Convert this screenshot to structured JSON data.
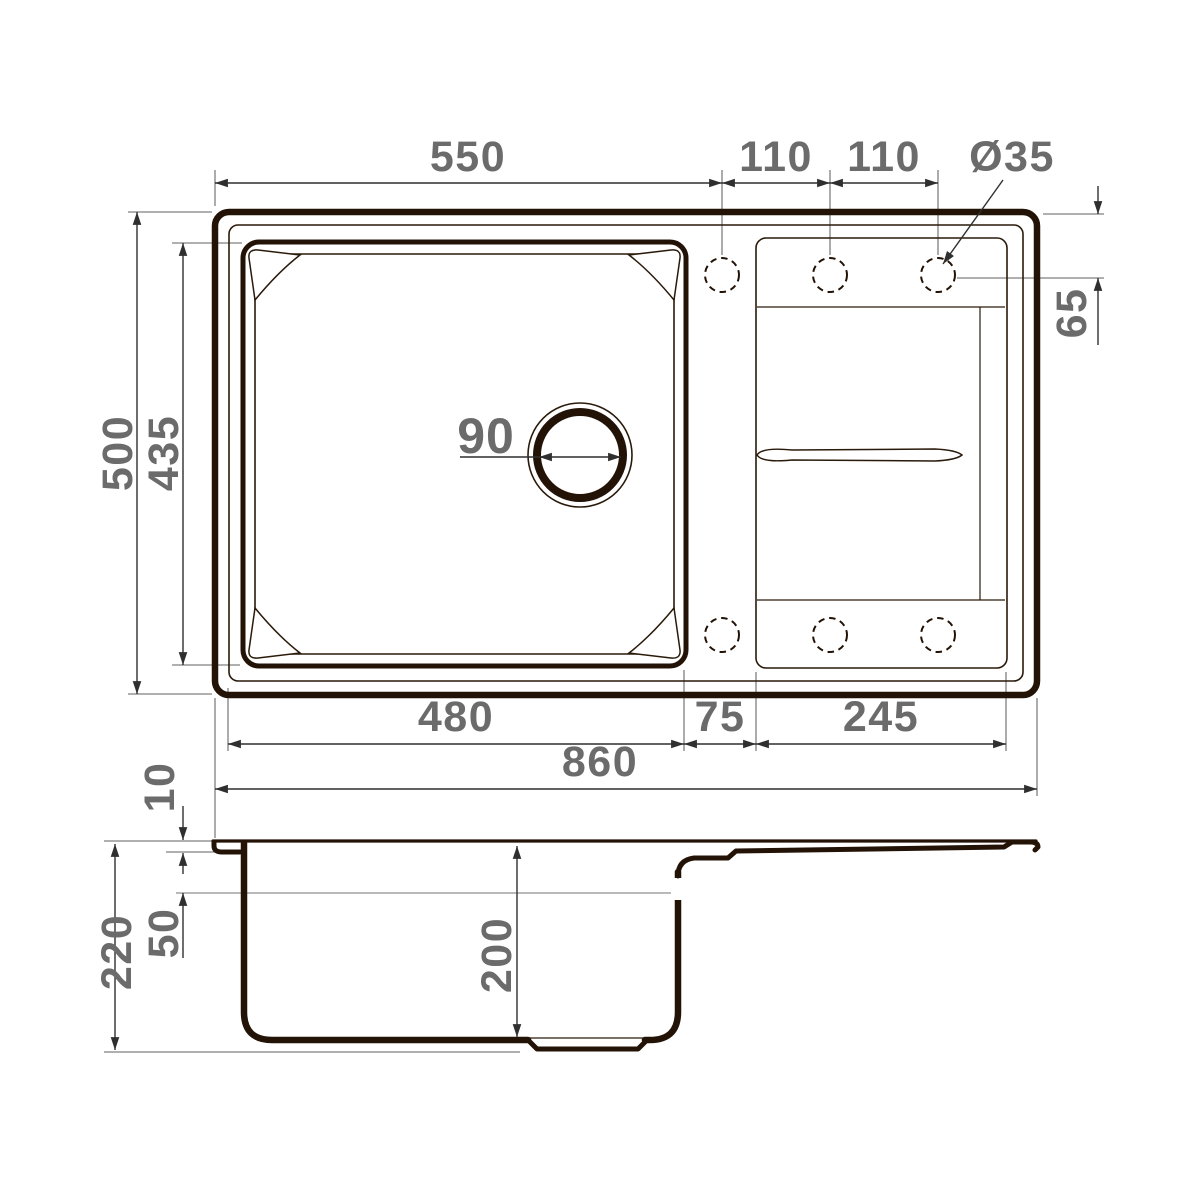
{
  "drawing": {
    "type": "kitchen-sink technical drawing, top view and section view",
    "units": "mm",
    "colors": {
      "outline_ink": "#231307",
      "dimension_line": "#2f2f2f",
      "label_text": "#6b6b6b",
      "background": "#ffffff"
    }
  },
  "dims": {
    "bowl_center_from_left": "550",
    "hole_pitch_1": "110",
    "hole_pitch_2": "110",
    "faucet_hole_diameter": "Ø35",
    "overall_depth": "500",
    "bowl_outer_depth": "435",
    "hole_center_from_edge": "65",
    "drain_diameter": "90",
    "bowl_outer_width": "480",
    "bowl_to_board_gap": "75",
    "drainboard_width": "245",
    "overall_width": "860",
    "rim_lip_height": "10",
    "overall_height": "220",
    "ledge_from_rim": "50",
    "bowl_depth": "200"
  }
}
